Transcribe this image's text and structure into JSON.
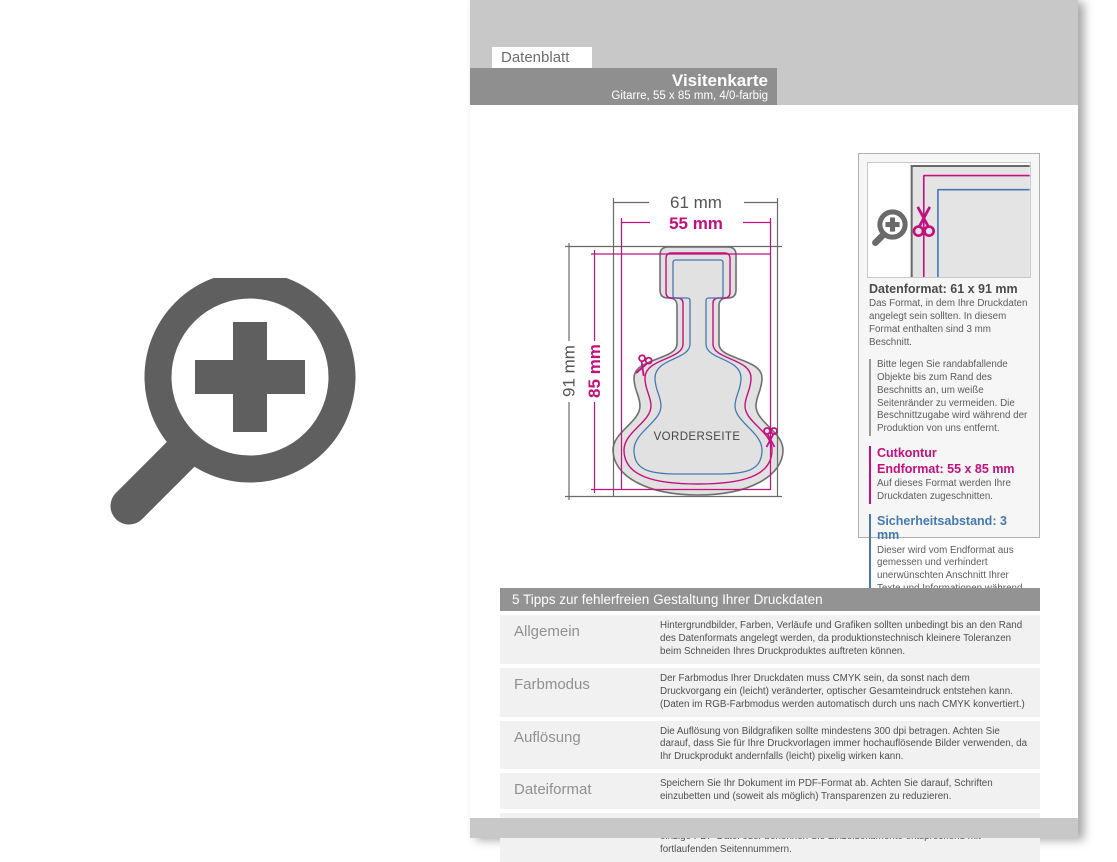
{
  "page": {
    "tab": "Datenblatt",
    "header": {
      "title": "Visitenkarte",
      "subtitle": "Gitarre, 55 x 85 mm, 4/0-farbig"
    }
  },
  "diagram": {
    "dim_width_outer": "61 mm",
    "dim_width_inner": "55 mm",
    "dim_height_outer": "91 mm",
    "dim_height_inner": "85 mm",
    "front_label": "VORDERSEITE"
  },
  "info_panel": {
    "datenformat_heading": "Datenformat: 61 x 91 mm",
    "datenformat_text": "Das Format, in dem Ihre Druckdaten angelegt sein sollten. In diesem Format enthalten sind 3 mm Beschnitt.",
    "bleed_note": "Bitte legen Sie randabfallende Objekte bis zum Rand des Beschnitts an, um weiße Seitenränder zu vermeiden. Die Beschnittzugabe wird während der Produktion von uns entfernt.",
    "cutkontur_heading": "Cutkontur",
    "endformat_heading": "Endformat: 55 x 85 mm",
    "endformat_text": "Auf dieses Format werden Ihre Druckdaten zugeschnitten.",
    "sicherheit_heading": "Sicherheitsabstand: 3 mm",
    "sicherheit_text": "Dieser wird vom Endformat aus gemessen und verhindert unerwünschten Anschnitt Ihrer Texte und Informationen während der Produktion."
  },
  "tips": {
    "heading": "5 Tipps zur fehlerfreien Gestaltung Ihrer Druckdaten",
    "rows": [
      {
        "label": "Allgemein",
        "text": "Hintergrundbilder, Farben, Verläufe und Grafiken sollten unbedingt bis an den Rand des Datenformats angelegt werden, da produktionstechnisch kleinere Toleranzen beim Schneiden Ihres Druckproduktes auftreten können."
      },
      {
        "label": "Farbmodus",
        "text": "Der Farbmodus Ihrer Druckdaten muss CMYK sein, da sonst nach dem Druckvorgang ein (leicht) veränderter, optischer Gesamteindruck entstehen kann. (Daten im RGB-Farbmodus werden automatisch durch uns nach CMYK konvertiert.)"
      },
      {
        "label": "Auflösung",
        "text": "Die Auflösung von Bildgrafiken sollte mindestens 300 dpi betragen. Achten Sie darauf, dass Sie für Ihre Druckvorlagen immer hochauflösende Bilder verwenden, da Ihr Druckprodukt andernfalls (leicht) pixelig wirken kann."
      },
      {
        "label": "Dateiformat",
        "text": "Speichern Sie Ihr Dokument im PDF-Format ab. Achten Sie darauf, Schriften einzubetten und (soweit als möglich) Transparenzen zu reduzieren."
      },
      {
        "label": "Seiten(-reihenfolge)",
        "text": "Senden Sie mehrseitige Dokumente chronologisch in korrekter Reihenfolge als eine einzige PDF-Datei oder benennen Sie Einzeldokumente entsprechend mit fortlaufenden Seitennummern."
      }
    ]
  },
  "colors": {
    "cut_magenta": "#c4107f",
    "safety_blue": "#4579b2",
    "bleed_gray": "#6a6a6a",
    "header_gray": "#8f8f8f"
  }
}
